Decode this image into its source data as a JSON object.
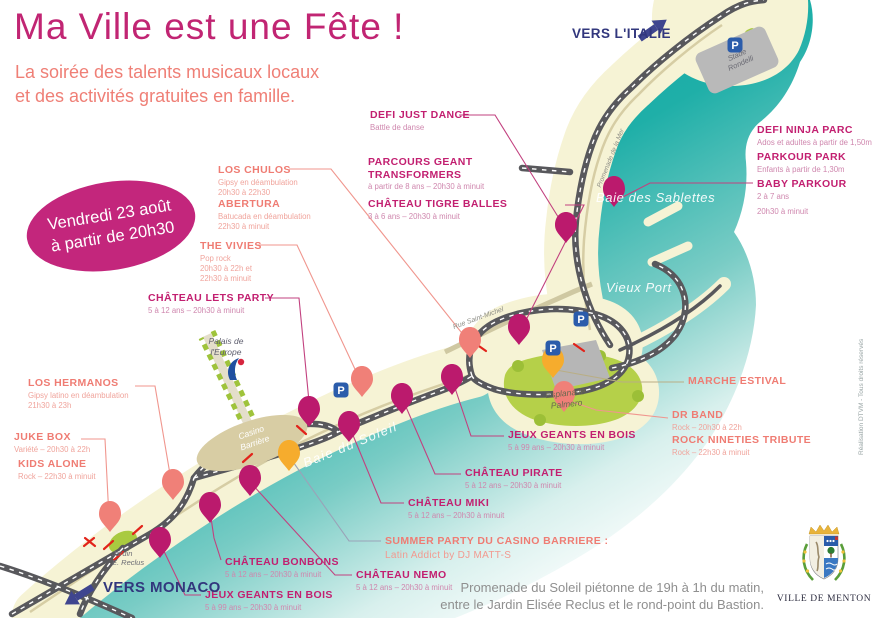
{
  "poster": {
    "title": "Ma Ville est une Fête !",
    "subtitle": "La soirée des talents musicaux locaux\net des activités gratuites en famille.",
    "date_badge": "Vendredi 23 août\nà partir de 20h30"
  },
  "events": {
    "los_chulos": {
      "name": "LOS CHULOS",
      "sub": "Gipsy en déambulation\n20h30 à 22h30"
    },
    "abertura": {
      "name": "ABERTURA",
      "sub": "Batucada en déambulation\n22h30 à minuit"
    },
    "the_vivies": {
      "name": "THE VIVIES",
      "sub": "Pop rock\n20h30 à 22h et\n22h30 à minuit"
    },
    "chateau_lets_party": {
      "name": "CHÂTEAU LETS PARTY",
      "sub": "5 à 12 ans – 20h30 à minuit"
    },
    "los_hermanos": {
      "name": "LOS HERMANOS",
      "sub": "Gipsy latino en déambulation\n21h30 à 23h"
    },
    "juke_box": {
      "name": "JUKE BOX",
      "sub": "Variété – 20h30 à 22h"
    },
    "kids_alone": {
      "name": "KIDS ALONE",
      "sub": "Rock – 22h30 à minuit"
    },
    "defi_just_dance": {
      "name": "DEFI JUST DANCE",
      "sub": "Battle de danse"
    },
    "parcours_transformers": {
      "name": "PARCOURS GEANT\nTRANSFORMERS",
      "sub": "à partir de 8 ans – 20h30 à minuit"
    },
    "chateau_tigre_balles": {
      "name": "CHÂTEAU TIGRE BALLES",
      "sub": "3 à 6 ans – 20h30 à minuit"
    },
    "defi_ninja_parc": {
      "name": "DEFI NINJA PARC",
      "sub": "Ados et adultes à partir de 1,50m"
    },
    "parkour_park": {
      "name": "PARKOUR PARK",
      "sub": "Enfants à partir de 1,30m"
    },
    "baby_parkour": {
      "name": "BABY PARKOUR",
      "sub": "2 à 7 ans"
    },
    "parkour_hours": {
      "sub": "20h30 à minuit"
    },
    "marche_estival": {
      "name": "MARCHE ESTIVAL",
      "sub": ""
    },
    "dr_band": {
      "name": "DR BAND",
      "sub": "Rock – 20h30 à 22h"
    },
    "rock_nineties": {
      "name": "ROCK NINETIES TRIBUTE",
      "sub": "Rock – 22h30 à minuit"
    },
    "jeux_geants_right": {
      "name": "JEUX GEANTS EN BOIS",
      "sub": "5 à 99 ans – 20h30 à minuit"
    },
    "chateau_pirate": {
      "name": "CHÂTEAU PIRATE",
      "sub": "5 à 12 ans – 20h30 à minuit"
    },
    "chateau_miki": {
      "name": "CHÂTEAU MIKI",
      "sub": "5 à 12 ans – 20h30 à minuit"
    },
    "summer_party": {
      "name": "SUMMER PARTY DU CASINO BARRIERE :",
      "sub": "Latin Addict by DJ MATT-S"
    },
    "chateau_nemo": {
      "name": "CHÂTEAU NEMO",
      "sub": "5 à 12 ans – 20h30 à minuit"
    },
    "chateau_bonbons": {
      "name": "CHÂTEAU BONBONS",
      "sub": "5 à 12 ans – 20h30 à minuit"
    },
    "jeux_geants_left": {
      "name": "JEUX GEANTS EN BOIS",
      "sub": "5 à 99 ans – 20h30 à minuit"
    }
  },
  "map": {
    "parking_label": "P",
    "places": {
      "vers_italie": "VERS L'ITALIE",
      "vers_monaco": "VERS MONACO",
      "stade": "Stade\nRondelli",
      "baie_sablettes": "Baie des Sablettes",
      "vieux_port": "Vieux Port",
      "baie_soleil": "Baie du Soleil",
      "esplanade": "Esplanade\nPalmero",
      "palais": "Palais de\nl'Europe",
      "casino": "Casino\nBarrière",
      "jardin": "Jardin\nE. Reclus",
      "rue_saint_michel": "Rue Saint-Michel",
      "promenade_mer": "Promenade de la Mer"
    }
  },
  "footer": {
    "notice": "Promenade du Soleil piétonne de 19h à 1h du matin,\nentre le Jardin Elisée Reclus et le rond-point du Bastion.",
    "city": "VILLE DE MENTON",
    "credit": "Réalisation DTVM - Tous droits réservés"
  },
  "colors": {
    "magenta": "#c2257c",
    "coral": "#ef7c73",
    "water": "#14a8a2",
    "land": "#f6f3d5",
    "green": "#aecb45",
    "orange": "#f6ac2d",
    "navy": "#3f458f",
    "road": "#58585c"
  }
}
